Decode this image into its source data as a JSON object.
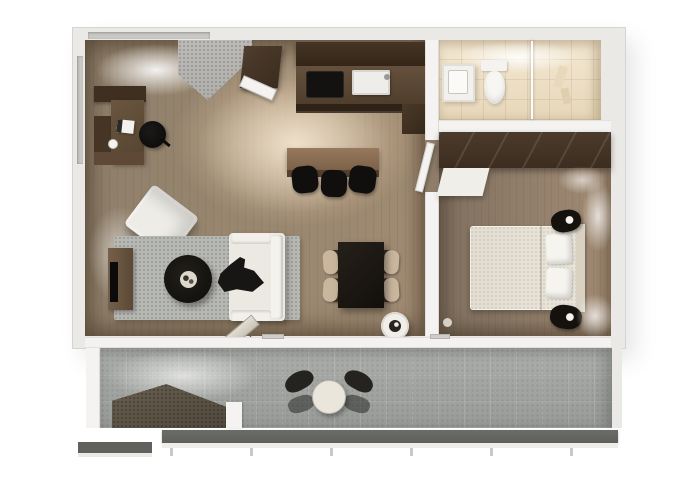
{
  "meta": {
    "title": "3D top-view floor plan of a one-bedroom apartment with balcony",
    "render_type": "architectural 3D floor plan, no visible text"
  },
  "colors": {
    "background": "#ffffff",
    "wall-face": "#eae9e6",
    "wall-edge": "#d6d4d0",
    "wall-white": "#f4f3f1",
    "window-glass": "#c9c8c4",
    "floor-living-dark": "#8d7d69",
    "floor-living-mid": "#98866f",
    "floor-living-light": "#a08a72",
    "floor-accent-beige": "#dec4a2",
    "floor-bedroom-dark": "#80705f",
    "floor-bedroom-light": "#a18a72",
    "floor-bathroom-light": "#f3e8d2",
    "floor-bathroom-dark": "#e7d7ba",
    "tile-entry": "#b0afab",
    "tile-balcony-light": "#abaeaa",
    "tile-balcony-dark": "#989b97",
    "rug": "#b7b8b4",
    "cabinet-darkest": "#332517",
    "cabinet-dark": "#463526",
    "cabinet-mid": "#5d4936",
    "cabinet-light": "#97795c",
    "furniture-black": "#141210",
    "furniture-white": "#efede8",
    "bed-cream": "#e5e0d4",
    "platform": "#5b5245",
    "railing": "#5d605b",
    "railing-base": "#eeedeb"
  },
  "rooms": [
    {
      "id": "living",
      "label": "Open-plan living and dining room"
    },
    {
      "id": "entry",
      "label": "Entry hall"
    },
    {
      "id": "kitchen",
      "label": "Kitchen"
    },
    {
      "id": "bathroom",
      "label": "Bathroom with shower"
    },
    {
      "id": "bedroom",
      "label": "Bedroom"
    },
    {
      "id": "balcony",
      "label": "Balcony terrace"
    }
  ],
  "furniture": {
    "desk": "Corner work desk with laptop",
    "office_chair": "Black office chair",
    "armchair": "White lounge armchair",
    "rug": "Grey living room rug",
    "coffee_table": "Round black coffee table",
    "tv_console": "TV sideboard",
    "tv": "Wall-mounted TV",
    "sofa": "White two-seat sofa with dark throw",
    "planter": "Round floor planter",
    "dining_table": "Dark dining table for four",
    "dining_chair": "Wood dining chair",
    "breakfast_bar": "Breakfast bar counter",
    "bar_stool": "Black bar stool",
    "kitchen_upper": "Kitchen upper cabinets",
    "kitchen_counter": "Kitchen counter",
    "cooktop": "Black cooktop",
    "sink": "Kitchen sink",
    "entry_closet": "Entry closet",
    "entry_door": "Open entrance door",
    "vanity": "Bathroom vanity with basin",
    "toilet": "Toilet",
    "shower": "Glass walk-in shower",
    "wardrobe": "Full-width wardrobe",
    "dresser": "White dresser",
    "bed": "Double bed with two pillows",
    "nightstand": "Black nightstand with lamp",
    "terrace_table": "Round bistro table",
    "terrace_chair": "Dark terrace chair",
    "deck_platform": "Dark deck platform",
    "railing": "Balcony railing"
  }
}
